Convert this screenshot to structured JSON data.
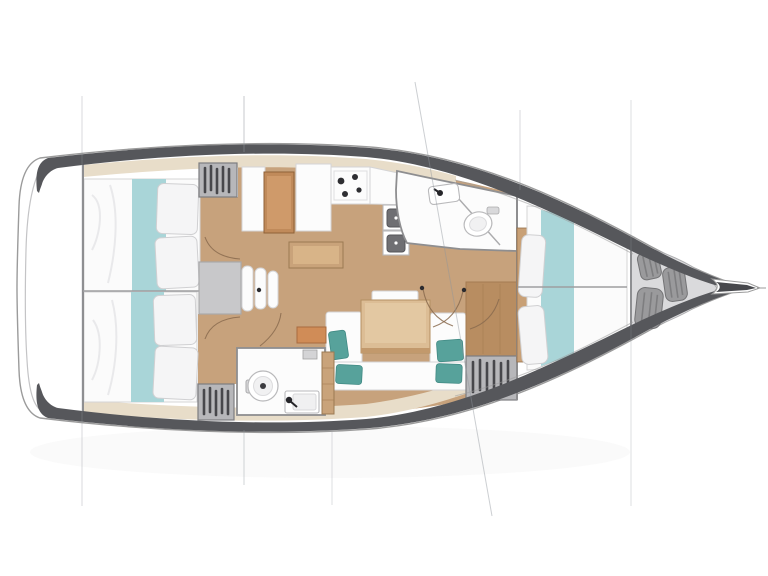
{
  "page": {
    "background": "#ffffff"
  },
  "drawing": {
    "type": "sailboat-interior-floorplan",
    "orientation": "bow-right",
    "cabins": 3,
    "heads": 2,
    "bow_fenders": 3
  },
  "colors": {
    "hull_band": "#56575b",
    "hull_outline": "#9b9b9b",
    "transom_line": "#c4c4c6",
    "deck_strip": "#e8ddc9",
    "floor_wood": "#c7a27c",
    "floor_wood_dark": "#b88d61",
    "plank_line": "#a47c52",
    "furniture_white": "#fcfcfc",
    "furniture_stroke": "#d4d4d6",
    "wall_stroke": "#8e8e90",
    "bedding_white": "#fbfbfb",
    "bedding_fold": "#e9e9eb",
    "pillow_stroke": "#d0d0d2",
    "bedding_teal": "#a9d5d8",
    "cushion_teal": "#57a29b",
    "cushion_edge": "#418a84",
    "locker_gray": "#b7b7ba",
    "locker_edge": "#7d7d80",
    "locker_stripe": "#47474b",
    "fender_gray": "#9a9a9c",
    "fender_edge": "#737375",
    "fender_stripe": "#7e7e80",
    "bow_locker": "#dadadc",
    "bow_locker_edge": "#aeaeb0",
    "bowsprit_dark": "#47484c",
    "steps_gray": "#c8c8ca",
    "steps_edge": "#a9a9ab",
    "table_wood": "#dcbd95",
    "table_edge": "#b39062",
    "table_shade": "#c2996c",
    "nav_wood": "#c08a5a",
    "nav_edge": "#8f6138",
    "island_wood": "#c9a37a",
    "island_edge": "#9b7a52",
    "accent_orange": "#d08c57",
    "accent_orange_edge": "#a86b3f",
    "sink_dark": "#6f6f73",
    "fixture_stroke": "#b9b9bb",
    "burner_black": "#2e2e32",
    "faucet_black": "#26262a",
    "door_arc": "#8a6b4f",
    "hinge_dot": "#2b2b2f",
    "rig_line": "#8f959b"
  }
}
